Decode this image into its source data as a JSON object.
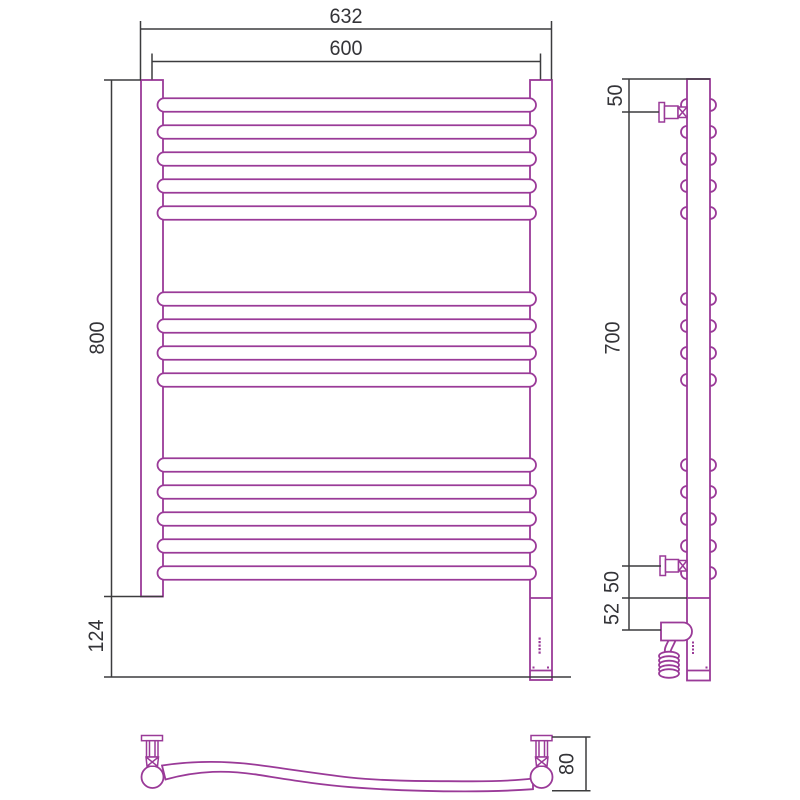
{
  "drawing": {
    "subject": "heated towel rail — dimensional drawing, three views",
    "colors": {
      "outline": "#9a3a98",
      "dimension": "#3c3c3e",
      "text": "#343438",
      "background": "#ffffff"
    },
    "front_view": {
      "bar_groups": [
        5,
        4,
        5
      ],
      "bar_total": 14,
      "dim_overall_width": "632",
      "dim_rail_span": "600",
      "dim_height": "800",
      "dim_bottom_unit": "124"
    },
    "side_view": {
      "dim_top_to_bracket": "50",
      "dim_bracket_to_bracket": "700",
      "dim_bracket_to_tube_end": "50",
      "dim_tube_end_to_element": "52"
    },
    "top_view": {
      "dim_depth": "80"
    }
  }
}
